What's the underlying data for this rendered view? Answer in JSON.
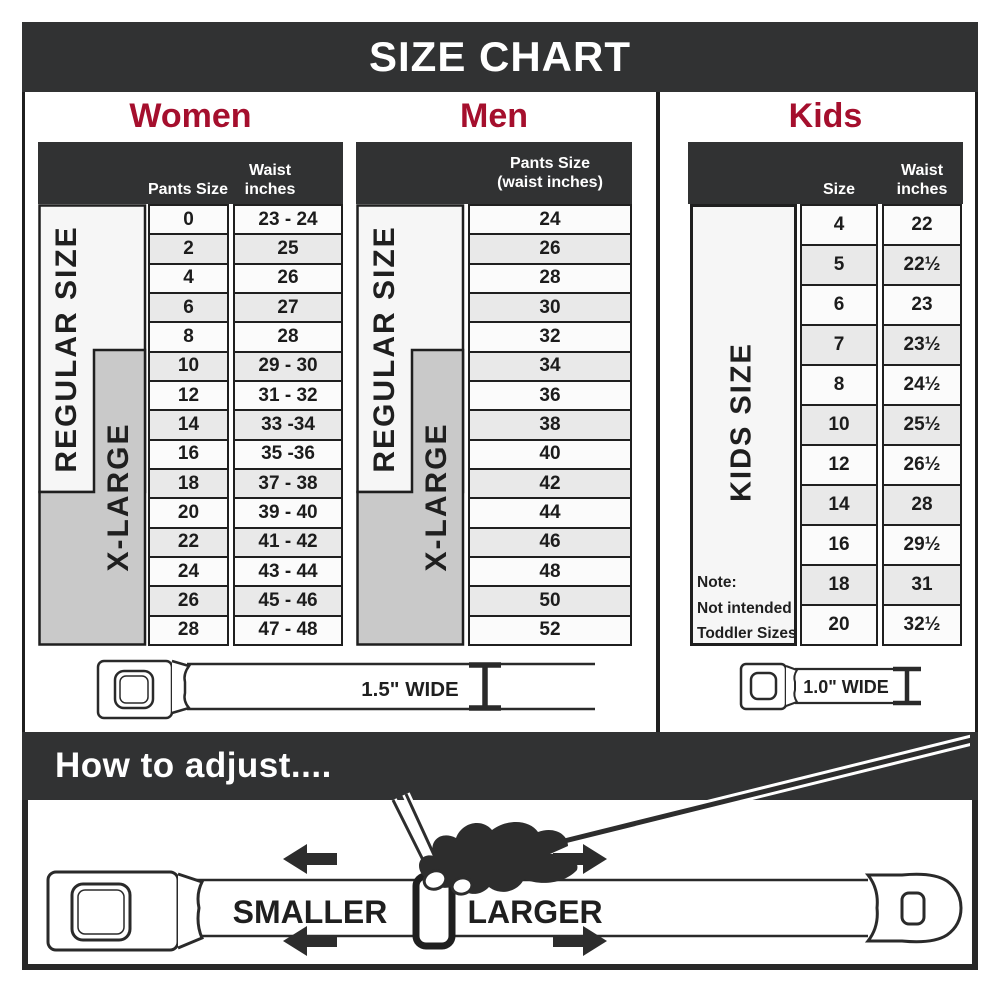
{
  "title": "SIZE CHART",
  "women": {
    "heading": "Women",
    "regular_label": "REGULAR SIZE",
    "xlarge_label": "X-LARGE",
    "col_pants": "Pants Size",
    "col_waist": "Waist inches",
    "rows": [
      {
        "size": "0",
        "waist": "23 - 24"
      },
      {
        "size": "2",
        "waist": "25"
      },
      {
        "size": "4",
        "waist": "26"
      },
      {
        "size": "6",
        "waist": "27"
      },
      {
        "size": "8",
        "waist": "28"
      },
      {
        "size": "10",
        "waist": "29 - 30"
      },
      {
        "size": "12",
        "waist": "31 - 32"
      },
      {
        "size": "14",
        "waist": "33 -34"
      },
      {
        "size": "16",
        "waist": "35 -36"
      },
      {
        "size": "18",
        "waist": "37 - 38"
      },
      {
        "size": "20",
        "waist": "39 - 40"
      },
      {
        "size": "22",
        "waist": "41 - 42"
      },
      {
        "size": "24",
        "waist": "43 - 44"
      },
      {
        "size": "26",
        "waist": "45 - 46"
      },
      {
        "size": "28",
        "waist": "47 - 48"
      }
    ]
  },
  "men": {
    "heading": "Men",
    "regular_label": "REGULAR SIZE",
    "xlarge_label": "X-LARGE",
    "header_line1": "Pants Size",
    "header_line2": "(waist inches)",
    "rows": [
      "24",
      "26",
      "28",
      "30",
      "32",
      "34",
      "36",
      "38",
      "40",
      "42",
      "44",
      "46",
      "48",
      "50",
      "52"
    ]
  },
  "kids": {
    "heading": "Kids",
    "kids_label": "KIDS SIZE",
    "col_size": "Size",
    "col_waist": "Waist inches",
    "note_line1": "Note:",
    "note_line2": "Not intended for",
    "note_line3": "Toddler Sizes (T)",
    "rows": [
      {
        "size": "4",
        "waist": "22"
      },
      {
        "size": "5",
        "waist": "22½"
      },
      {
        "size": "6",
        "waist": "23"
      },
      {
        "size": "7",
        "waist": "23½"
      },
      {
        "size": "8",
        "waist": "24½"
      },
      {
        "size": "10",
        "waist": "25½"
      },
      {
        "size": "12",
        "waist": "26½"
      },
      {
        "size": "14",
        "waist": "28"
      },
      {
        "size": "16",
        "waist": "29½"
      },
      {
        "size": "18",
        "waist": "31"
      },
      {
        "size": "20",
        "waist": "32½"
      }
    ]
  },
  "belts": {
    "adult_label": "1.5\" WIDE",
    "kids_label": "1.0\" WIDE"
  },
  "adjust": {
    "heading": "How to adjust....",
    "smaller": "SMALLER",
    "larger": "LARGER"
  },
  "colors": {
    "dark_bar": "#313233",
    "heading_red": "#a50f2d",
    "table_border": "#1f1f1f",
    "xlarge_gray": "#c9c9c9",
    "row_alt_gray": "#e9e9e9"
  }
}
